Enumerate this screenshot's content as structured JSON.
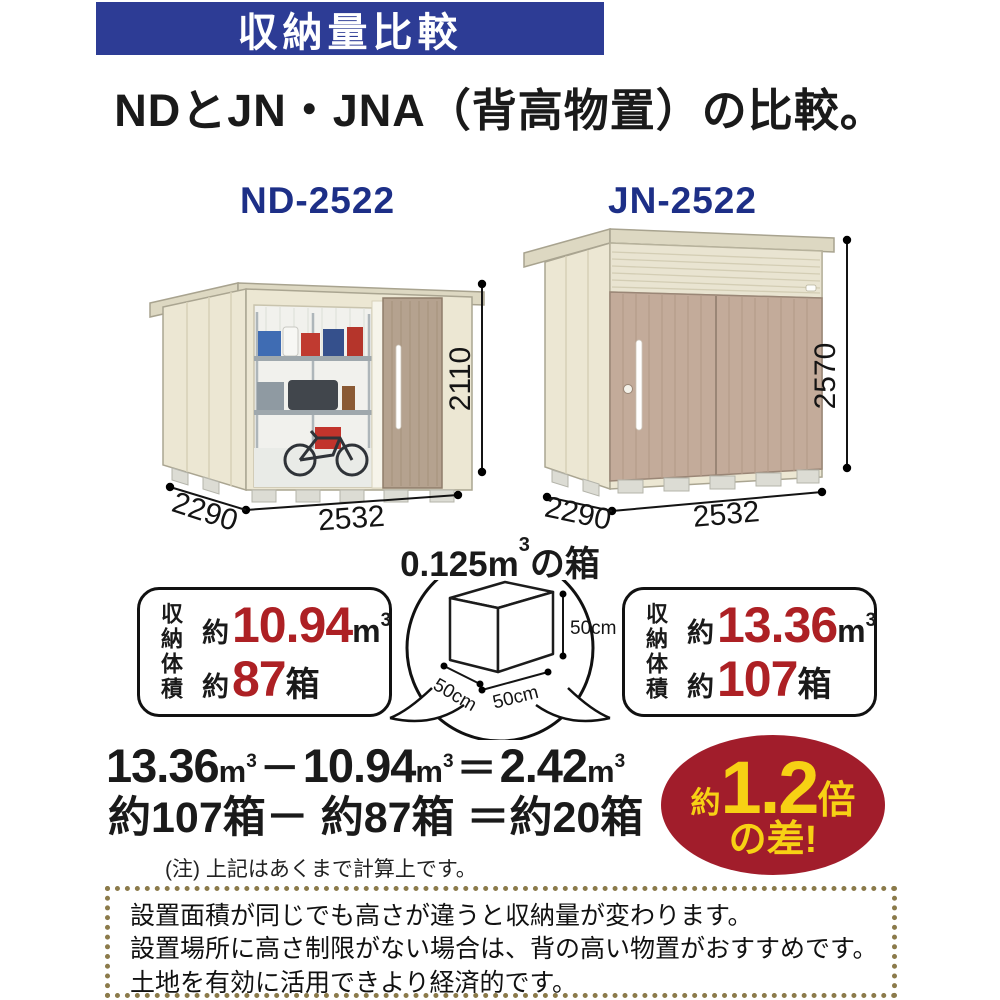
{
  "banner": {
    "label": "収納量比較"
  },
  "title": "NDとJN・JNA（背高物置）の比較。",
  "products": {
    "left": {
      "model": "ND-2522",
      "width": "2532",
      "depth": "2290",
      "height": "2110"
    },
    "right": {
      "model": "JN-2522",
      "width": "2532",
      "depth": "2290",
      "height": "2570"
    }
  },
  "cube": {
    "title_value": "0.125m",
    "title_sup": "3",
    "title_suffix": "の箱",
    "side": "50cm"
  },
  "volume_boxes": {
    "label_vertical": "収納体積",
    "left": {
      "approx": "約",
      "volume": "10.94",
      "unit": "m",
      "unit_sup": "3",
      "boxes": "87",
      "boxes_unit": "箱"
    },
    "right": {
      "approx": "約",
      "volume": "13.36",
      "unit": "m",
      "unit_sup": "3",
      "boxes": "107",
      "boxes_unit": "箱"
    }
  },
  "calculation": {
    "v1": "13.36",
    "minus": "－",
    "v2": "10.94",
    "equals": "＝",
    "v3": "2.42",
    "unit": "m",
    "unit_sup": "3",
    "line2": "約107箱－ 約87箱 ＝約20箱",
    "note": "(注) 上記はあくまで計算上です。"
  },
  "difference_badge": {
    "approx": "約",
    "value": "1.2",
    "times": "倍",
    "suffix": "の差!"
  },
  "footer_box": {
    "lines": [
      "設置面積が同じでも高さが違うと収納量が変わります。",
      "設置場所に高さ制限がない場合は、背の高い物置がおすすめです。",
      "土地を有効に活用できより経済的です。"
    ]
  },
  "colors": {
    "banner_bg": "#2d3c95",
    "model_navy": "#1d2f87",
    "accent_red": "#ad2024",
    "badge_bg": "#a11d2b",
    "badge_text": "#f7d114",
    "footer_border": "#8b7a4a",
    "shed_wall": "#ece7d3",
    "shed_door_tan": "#b5a28f",
    "shed_door_tan_jn": "#c3ab9a"
  }
}
